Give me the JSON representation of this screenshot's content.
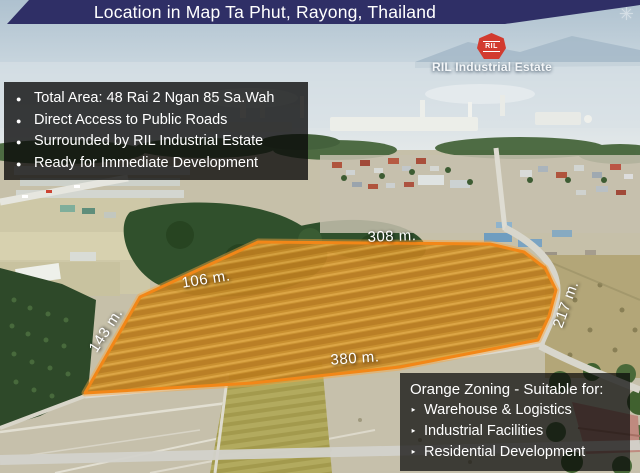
{
  "banner": {
    "title": "Location in Map Ta Phut, Rayong, Thailand"
  },
  "logo": {
    "monogram": "RIL",
    "caption": "RIL Industrial Estate"
  },
  "watermark": {
    "char": "✳"
  },
  "info_box": {
    "bullet_char": "●",
    "items": [
      "Total Area: 48 Rai 2 Ngan 85 Sa.Wah",
      "Direct Access to Public Roads",
      "Surrounded by RIL Industrial Estate",
      "Ready for Immediate Development"
    ]
  },
  "parcel": {
    "dim_top": "308 m.",
    "dim_upper_left": "106 m.",
    "dim_left": "143 m.",
    "dim_bottom": "380 m.",
    "dim_right": "217 m."
  },
  "zoning_box": {
    "heading": "Orange Zoning - Suitable for:",
    "bullet_char": "‣",
    "items": [
      "Warehouse & Logistics",
      "Industrial Facilities",
      "Residential Development"
    ]
  },
  "colors": {
    "banner_bg": "#2f2f66",
    "logo_red": "#d23b2f",
    "parcel_boundary_orange": "#f28718",
    "info_box_bg": "rgba(0,0,0,0.78)"
  }
}
